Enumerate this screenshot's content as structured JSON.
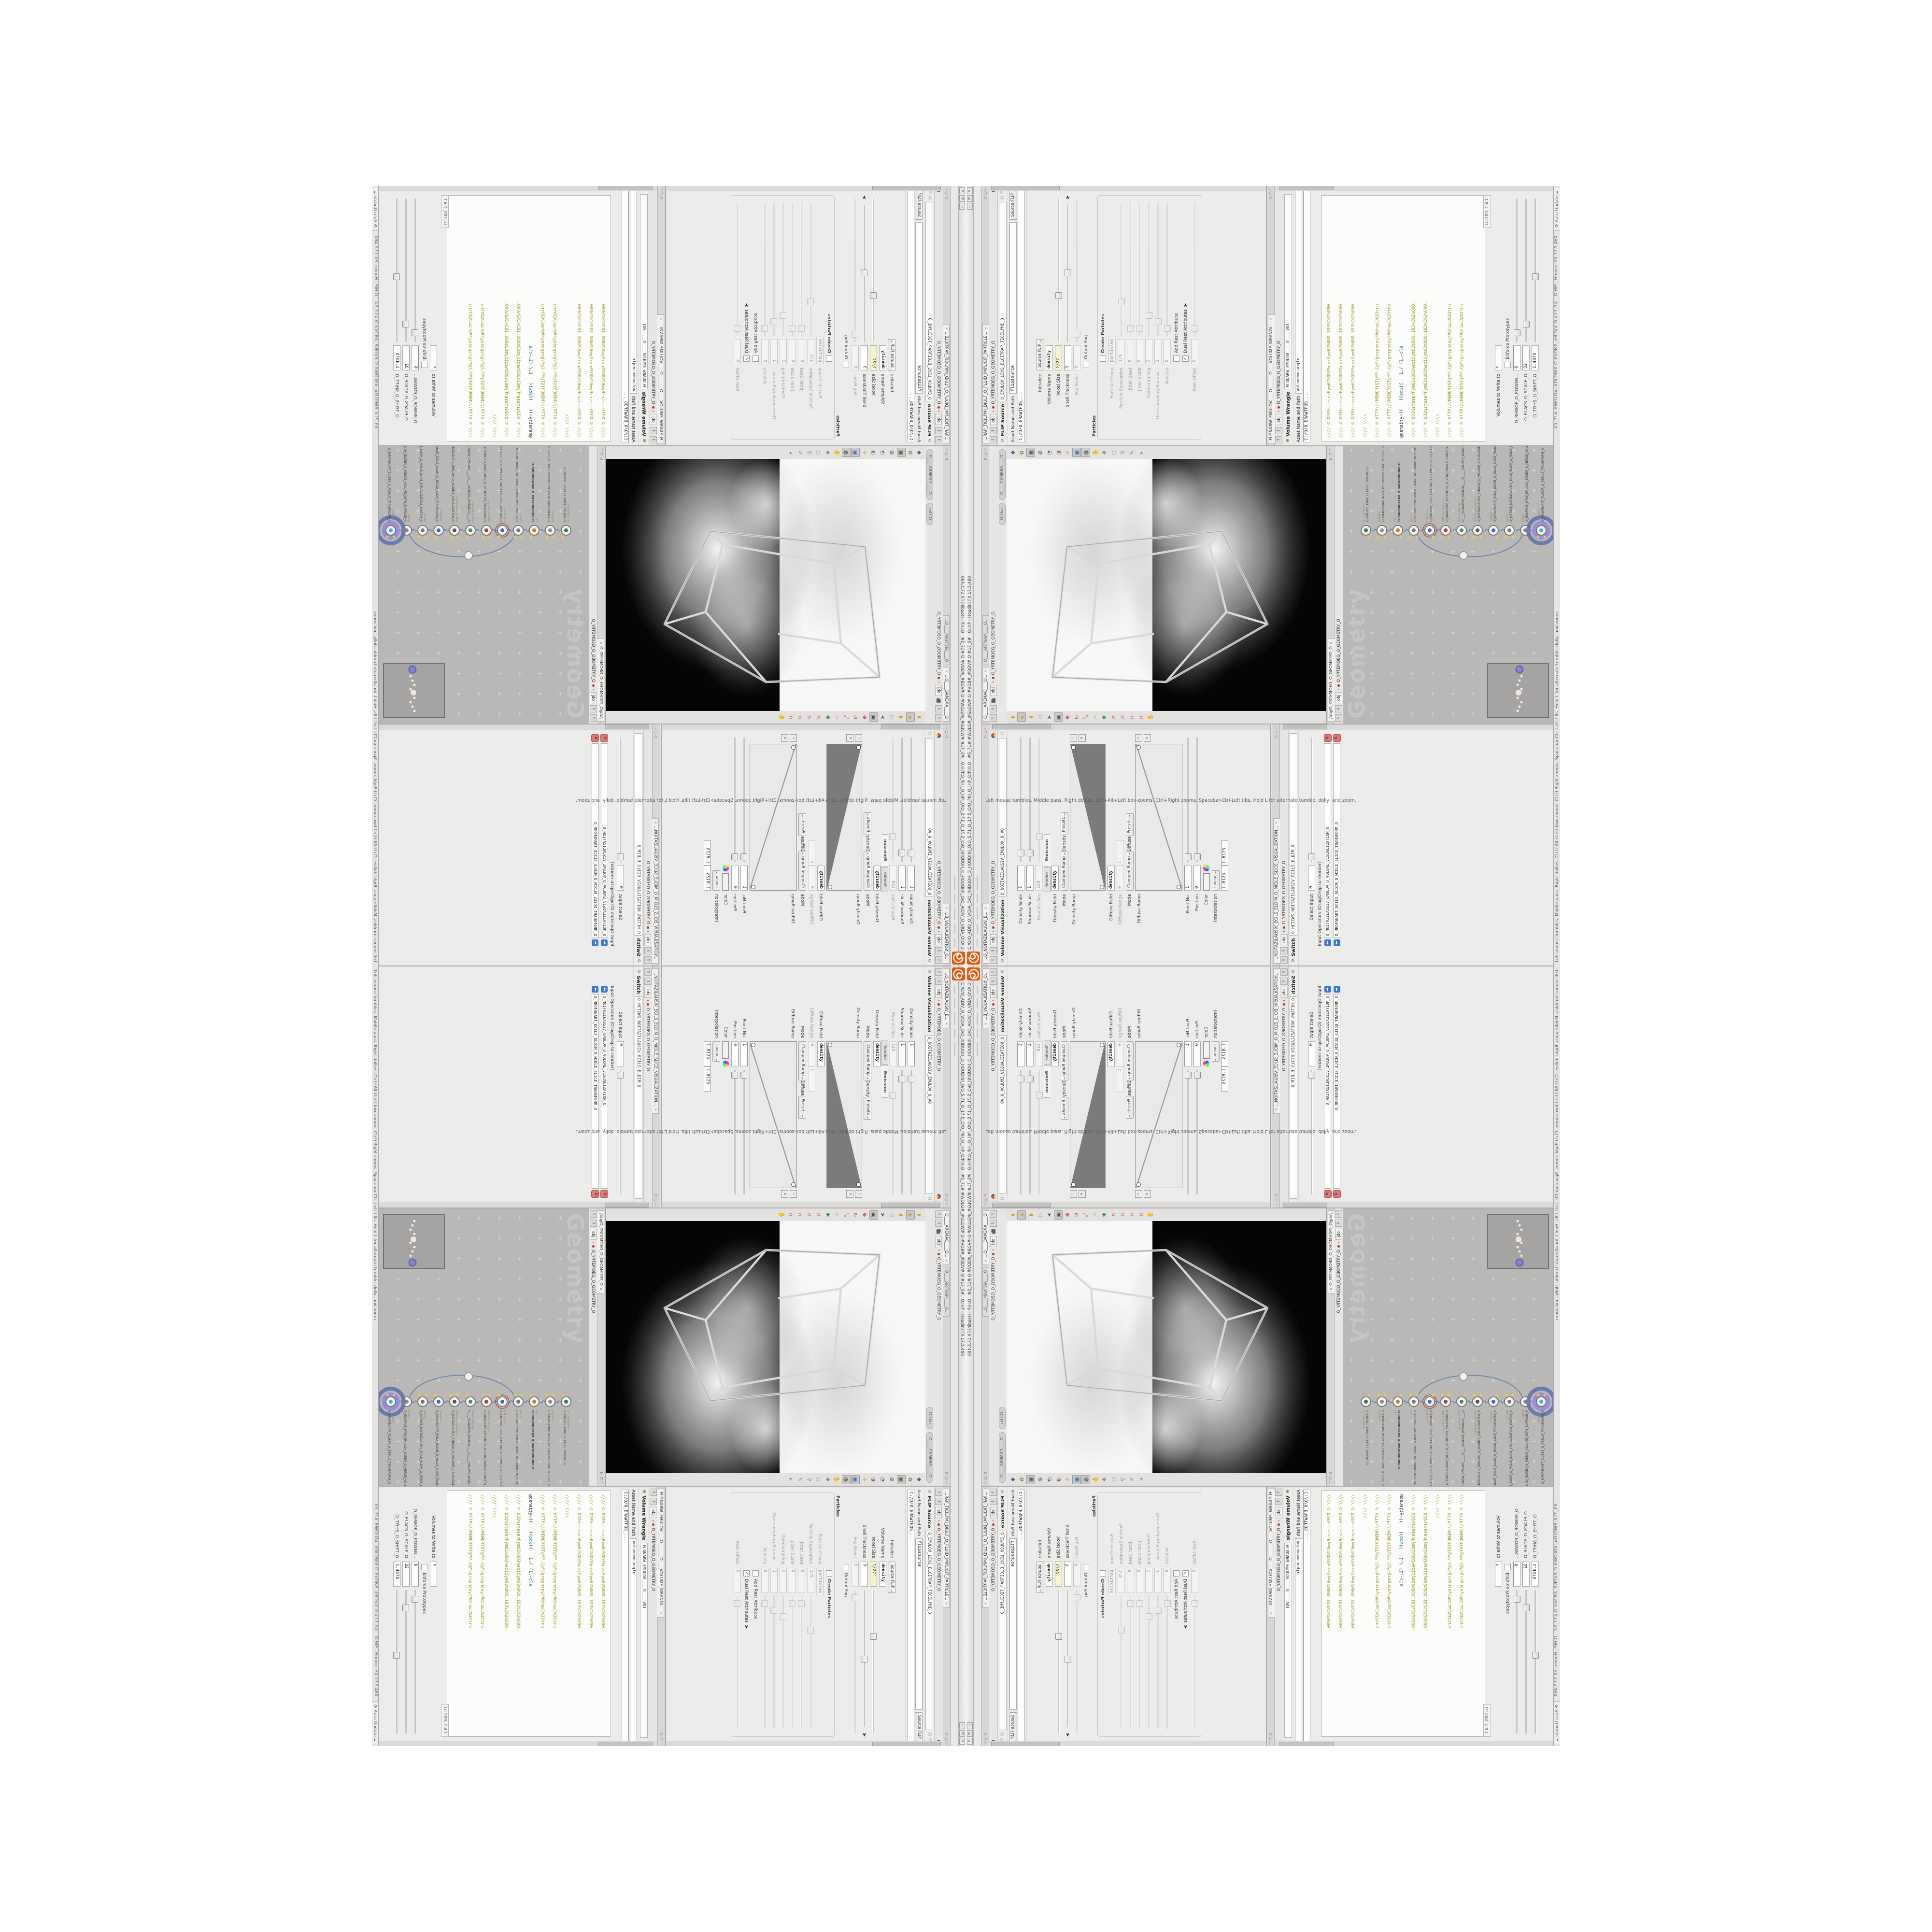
{
  "window": {
    "title": "C:/O/O_ADIV_O_VIDIA_O/O_INIDUOH_O_HOUDINI_O/O_5.71_O_17.5_O/O_PIH_O_HIP_O/PIH.O",
    "badges": "#5_71#   #WOLG#_#GLOW#   O   #VDB#_#BDV#   O   #17_5#",
    "app": "O.HIP - Houdini FX 17.5.460",
    "buttons": {
      "minimize": "▭",
      "maximize": "⧉",
      "close": "✕"
    }
  },
  "statusbar": {
    "help": "Left mouse tumbles. Middle pans. Right dollies. Ctrl+Alt+Left box-zooms. Ctrl+Right zooms. Spacebar-Ctrl-Left tilts. Hold L for alternate tumble, dolly, and zoom.",
    "auto_update": "Auto Update"
  },
  "path": {
    "root": "obj",
    "net": "O_YRTEMOEG_O_GEOMETRY_O",
    "full": "/obj/O_YRTEMOEG_O_GEOMETRY_O"
  },
  "flip": {
    "tab": "...RAP_TICILPMI_DIULF_O_FLUID_IMPLICIT_PARTICLE...",
    "type": "FLIP Source",
    "name": "O_EMULOV_LEHS_ELCITRAP_TICILPMI_D",
    "asset_label": "Asset Name and Path",
    "asset_name": "flipsource",
    "asset_menu": "Source FLIP",
    "asset_path": "C:/O/O_ERAWTFOS_...",
    "params": [
      {
        "l": "Initialize",
        "w": [
          {
            "k": "sel",
            "v": "Source FLIP"
          }
        ]
      },
      {
        "l": "Volume Name",
        "w": [
          {
            "k": "f",
            "v": "density",
            "c": "bold"
          }
        ]
      },
      {
        "l": "Voxel Size",
        "w": [
          {
            "k": "f",
            "v": "1/27",
            "c": "yellow"
          },
          {
            "k": "s",
            "f": 0.32
          }
        ]
      },
      {
        "l": "Shell Thickness",
        "w": [
          {
            "k": "f",
            "v": "3"
          },
          {
            "k": "s",
            "f": 0.5
          },
          {
            "k": "cur"
          }
        ]
      },
      {
        "l": "Fog Boost",
        "dim": 1,
        "w": [
          {
            "k": "f",
            "v": "0"
          },
          {
            "k": "s",
            "f": 0.05
          }
        ]
      },
      {
        "l": "",
        "w": [
          {
            "k": "chk",
            "on": 0
          },
          {
            "k": "lab",
            "v": "Output Fog"
          }
        ]
      },
      {
        "group": "Particles"
      },
      {
        "l": "",
        "g": 1,
        "w": [
          {
            "k": "chk",
            "on": 0
          },
          {
            "k": "lab",
            "v": "Create Particles",
            "c": "bold"
          }
        ]
      },
      {
        "l": "Particle Group",
        "g": 1,
        "dim": 1,
        "w": [
          {
            "k": "f",
            "v": "particles"
          }
        ]
      },
      {
        "l": "Particle Separation",
        "g": 1,
        "dim": 1,
        "w": [
          {
            "k": "f",
            "v": "1/9"
          },
          {
            "k": "s",
            "f": 0.25
          }
        ]
      },
      {
        "l": "Jitter Seed",
        "g": 1,
        "dim": 1,
        "w": [
          {
            "k": "f",
            "v": "0"
          },
          {
            "k": "s",
            "f": 0.05
          }
        ]
      },
      {
        "l": "Jitter Scale",
        "g": 1,
        "dim": 1,
        "w": [
          {
            "k": "f",
            "v": "0"
          },
          {
            "k": "s",
            "f": 0.05
          }
        ]
      },
      {
        "l": "Oversampling",
        "g": 1,
        "dim": 1,
        "w": [
          {
            "k": "f",
            "v": "2"
          },
          {
            "k": "s",
            "f": 0.15
          }
        ]
      },
      {
        "l": "Oversampling Bandwi...",
        "g": 1,
        "dim": 1,
        "w": [
          {
            "k": "f",
            "v": "1"
          },
          {
            "k": "s",
            "f": 0.1
          }
        ]
      },
      {
        "l": "Velocity",
        "g": 1,
        "dim": 1,
        "w": [
          {
            "k": "f",
            "v": "0"
          },
          {
            "k": "s",
            "f": 0.05
          }
        ]
      },
      {
        "l": "",
        "g": 1,
        "w": [
          {
            "k": "chk",
            "on": 0
          },
          {
            "k": "lab",
            "v": "Add Rest Attribute"
          }
        ]
      },
      {
        "l": "",
        "g": 1,
        "w": [
          {
            "k": "chk",
            "on": 1
          },
          {
            "k": "lab",
            "v": "Dual Rest Attributes"
          },
          {
            "k": "cur"
          }
        ]
      },
      {
        "l": "Rest Offset",
        "g": 1,
        "dim": 1,
        "w": [
          {
            "k": "f",
            "v": "0"
          },
          {
            "k": "s",
            "f": 0.05
          }
        ]
      }
    ]
  },
  "wrangle": {
    "tab": "ELGNARW_EMULOV____O_______O____VOLUME_WRANGL...",
    "type": "Volume Wrangle",
    "name": "ELGNARW_EMULOV____O____VOI",
    "asset_label": "Asset Name and Path",
    "asset_name": "volumewrangle",
    "asset_path": "C:/O/O_ERAWTFOS_...",
    "code": [
      {
        "c": "lc",
        "t": "//// © 0D3%steserPym62%0D3%eziSym62%000.1D3%C62%000."
      },
      {
        "c": "lc",
        "t": "//// © 0D3%steserPym62%0D3%eziSym62%000.1D3%C62%000."
      },
      {
        "c": "lc",
        "t": "//// © 0D3%steserPym62%0D3%eziSym62%000.1D3%C62%000."
      },
      {
        "c": "lc",
        "t": "//// \\\\\\\\"
      },
      {
        "c": "lc",
        "t": "//// © HTTP://MEMORYST@MP.C@M/graphtoy/#draw1%3Dtru"
      },
      {
        "c": "lc",
        "t": "//// © HTTP://MEMORYST@MP.C@M/graphtoy/#draw1%3Dtru"
      },
      {
        "seg": [
          [
            "@density=((   ",
            "lk"
          ],
          [
            "((",
            "lk"
          ],
          [
            "pow",
            "lfn"
          ],
          [
            "((   ",
            "lk"
          ],
          [
            "1./ (1.-",
            "lk"
          ],
          [
            "cla",
            "lfn"
          ]
        ]
      },
      {
        "c": "lc",
        "t": "//// © 0D3%steserPym62%0D3%eziSym62%000.1D3%C62%000."
      },
      {
        "c": "lc",
        "t": "//// © 0D3%steserPym62%0D3%eziSym62%000.1D3%C62%000."
      },
      {
        "c": "lc",
        "t": "//// \\\\\\\\"
      },
      {
        "c": "lc",
        "t": "//// © HTTP://MEMORYST@MP.C@M/graphtoy/#draw1%3Dtru"
      },
      {
        "c": "lc",
        "t": "//// © HTTP://MEMORYST@MP.C@M/graphtoy/#draw1%3Dtru"
      }
    ],
    "ln": "Ln 209, Col 1",
    "params": [
      {
        "l": "Volumes to Write to",
        "w": [
          {
            "k": "f",
            "v": "*"
          }
        ]
      },
      {
        "l": "",
        "w": [
          {
            "k": "chk",
            "on": 0
          },
          {
            "k": "lab",
            "v": "Enforce Prototypes"
          }
        ]
      },
      {
        "l": "O_REWOP_O_POWER...",
        "w": [
          {
            "k": "f",
            "v": "6"
          },
          {
            "k": "s",
            "f": 0.06
          }
        ]
      },
      {
        "l": "O_ELACS_O_SCALE_O",
        "w": [
          {
            "k": "f",
            "v": "32"
          },
          {
            "k": "s",
            "f": 0.12
          }
        ]
      },
      {
        "l": "O_TFIHS_O_SHIFT_O",
        "w": [
          {
            "k": "f",
            "v": "1.4375"
          },
          {
            "k": "s",
            "f": 0.45
          }
        ]
      }
    ]
  },
  "volvis": {
    "tab": "...O_NOITAZILAUSIV_E...",
    "type": "Volume Visualization",
    "name": "O_NOITAZILAUSIV_EMULOV_O_VO",
    "params": [
      {
        "l": "Density Scale",
        "w": [
          {
            "k": "f",
            "v": "1"
          },
          {
            "k": "s",
            "f": 0.07
          }
        ]
      },
      {
        "l": "Shadow Scale",
        "w": [
          {
            "k": "f",
            "v": "1"
          },
          {
            "k": "s",
            "f": 0.07
          }
        ]
      },
      {
        "l": "Max Vis Res",
        "dim": 1,
        "w": [
          {
            "k": "f",
            "v": "128"
          },
          {
            "k": "s",
            "f": 0.2
          }
        ]
      },
      {
        "tabs": [
          "Smoke",
          "Emission"
        ],
        "active": 1
      },
      {
        "l": "Density Field",
        "w": [
          {
            "k": "f",
            "v": "density",
            "c": "bold"
          }
        ]
      },
      {
        "l": "Mode",
        "w": [
          {
            "k": "sel",
            "v": "Clamped Ramp"
          },
          {
            "k": "lab",
            "v": "Density"
          },
          {
            "k": "sel",
            "v": "Presets"
          }
        ]
      },
      {
        "ramp": "wedge",
        "l": "Density Ramp",
        "h": 72
      },
      {
        "l": "Diffuse Field",
        "w": [
          {
            "k": "f",
            "v": "density",
            "c": "bold"
          }
        ]
      },
      {
        "l": "Diffuse Range",
        "dim": 1,
        "w": [
          {
            "k": "f",
            "v": "0"
          },
          {
            "k": "f",
            "v": "1"
          }
        ]
      },
      {
        "l": "Mode",
        "w": [
          {
            "k": "sel",
            "v": "Clamped Ramp"
          },
          {
            "k": "lab",
            "v": "Diffuse"
          },
          {
            "k": "sel",
            "v": "Presets"
          }
        ]
      },
      {
        "ramp": "line",
        "l": "Diffuse Ramp",
        "h": 96
      },
      {
        "l": "Point No.",
        "w": [
          {
            "k": "f",
            "v": "1"
          },
          {
            "k": "s",
            "f": 0.04
          }
        ]
      },
      {
        "l": "Position",
        "w": [
          {
            "k": "f",
            "v": "0"
          },
          {
            "k": "s",
            "f": 0.04
          }
        ]
      },
      {
        "l": "Color",
        "w": [
          {
            "k": "sw"
          },
          {
            "k": "wheel"
          }
        ]
      },
      {
        "l": "Interpolation",
        "w": [
          {
            "k": "sel",
            "v": "Linear"
          }
        ]
      },
      {
        "l": "",
        "w": [
          {
            "k": "f",
            "v": "1.8125"
          },
          {
            "k": "f",
            "v": "1.8125"
          }
        ]
      }
    ]
  },
  "switch": {
    "tab": "...NOITAZILAUSIV_ECILS_ELDIM_O_MIDLE_SLICE_VISUALIZATION...",
    "type": "Switch",
    "name": "O_HCTIWS_NOITAZILAUSIV_ECILS_ELDIM_O",
    "params": [
      {
        "l": "Select Input",
        "w": [
          {
            "k": "f",
            "v": "0"
          },
          {
            "k": "s",
            "f": 0.04
          }
        ]
      }
    ],
    "oplabel": "Input Operators (Drag/Drop to reorder)",
    "ops": [
      "O_NOITAZILAUSIV_EMULOV_O_VOLUME_VISUALIZATION_O",
      "O_MROFSNART_ECILS_ELDIM_O_MIDLE_SLICE_TRANSFORM_O"
    ]
  },
  "viewport": {
    "tab_scene": "O____AREMAC____O...",
    "tab_render": "O____ARTNAM____O...",
    "pill_ortho": "Ortho",
    "pill_camera": "O____CAMERA____O",
    "display_icons": [
      {
        "g": "◆",
        "c": "#556070"
      },
      {
        "g": "✿",
        "c": "#4a8f3a"
      },
      {
        "g": "▣",
        "c": "#5a5a5a",
        "on": 1
      },
      {
        "g": "⊘",
        "c": "#333333"
      },
      {
        "g": "◔",
        "c": "#555555"
      },
      {
        "g": "◑",
        "c": "#777777"
      },
      {
        "g": "✛",
        "c": "#c9a227"
      },
      {
        "g": "▣",
        "c": "#3a6fc4",
        "on": 1
      },
      {
        "g": "◍",
        "c": "#2f2f2f",
        "on": 1
      },
      {
        "g": "✋",
        "c": "#70757d"
      },
      {
        "g": "❖",
        "c": "#70757d"
      },
      {
        "g": "○",
        "c": "#8a8a8a"
      },
      {
        "g": "⚲",
        "c": "#8a8a8a"
      },
      {
        "g": "✎",
        "c": "#8a8a8a"
      },
      {
        "g": "▸",
        "c": "#8a8a8a"
      }
    ],
    "tool_icons": [
      {
        "g": "◗",
        "c": "#c9a227"
      },
      {
        "g": "◈",
        "c": "#c9a227",
        "on": 1
      },
      {
        "g": "◖",
        "c": "#c9a227"
      },
      {
        "g": "◁",
        "c": "#999999"
      },
      {
        "g": "➤",
        "c": "#4a4a4a"
      },
      {
        "g": "▣",
        "c": "#4a4a4a",
        "on": 1
      },
      {
        "g": "✥",
        "c": "#c23b3b"
      },
      {
        "g": "↻",
        "c": "#c23b3b"
      },
      {
        "g": "⤡",
        "c": "#c23b3b"
      },
      {
        "g": "✂",
        "c": "#cc9999"
      },
      {
        "g": "✱",
        "c": "#3a8f3a"
      },
      {
        "g": "∩",
        "c": "#c23b3b"
      },
      {
        "g": "∩",
        "c": "#c23b3b"
      },
      {
        "g": "∩",
        "c": "#c23b3b"
      },
      {
        "g": "∩",
        "c": "#c23b3b"
      },
      {
        "g": "✋",
        "c": "#70757d"
      }
    ]
  },
  "network": {
    "watermark": "Geometry",
    "nodes": [
      {
        "sub": "an_CubeSphere",
        "label": "O_EREHPS_EBUC_O_CUBE_SPHERE_O",
        "c": "#3a7d44"
      },
      {
        "sub": "PolyWire",
        "label": "O_EMARFERIW_NOGYLOP_EREHPS_EBUC_O_CUBE_SPHERE_POLYGON_WIREFRAME_O",
        "c": "#8a8a8a"
      },
      {
        "sub": "File",
        "label": "O_DNUORGKCAB_O_BACKGROUND_O",
        "bold": 1,
        "c": "#d07a2c"
      },
      {
        "sub": "Switch",
        "label": "O_HCTIWS_YRTEMOEG_LANRETXE_LANRETNI_O_INTERNAL_EXTERNAL_GEOMETRY_SWITCH_O",
        "c": "#777777"
      },
      {
        "sub": "FLIP Source",
        "label": "O_EMULOV_LEHS_ELCITRAP_TICILPMI_DIULF_O_FLUID_IMPLICIT_PARTICLE_SHEL_VOLUME_O",
        "ring": "#b05050",
        "c": "#4a6fa5"
      },
      {
        "sub": "VDB from Polygons",
        "label": "O_SNOGILOP_YRTEMOEG_O_VDB_FROM_GEOMETRY_BDV_O",
        "c": "#b04040"
      },
      {
        "sub": "Volume Wrangle",
        "label": "O____ELGNARW_EMULOV____O_____VOLUME_WRANGLE_O",
        "c": "#4f8f4f",
        "dot2": "#8fb7e8"
      },
      {
        "sub": "Volume Visualization",
        "label": "O_NOITAZILAUSIV_EMULOV_O_VOLUME_VISUALIZATION_O",
        "c": "#5a5a5a"
      },
      {
        "sub": "Transform",
        "label": "O_MROFSNART_ECILS_ELDIM_O_MIDLE_SLICE_TRANSFORM_O",
        "c": "#3a6fc4"
      },
      {
        "sub": "Switch",
        "label": "O_HCTIWS_NOITAZILAUSIV_ECILS_ELDIM_O_MIDLE_SLICE_VISUALIZATION_SWITCH_O",
        "c": "#777777"
      },
      {
        "sub": "Merge",
        "label": "O_ECAFRUS_HTIW_EMULOV_EGREM_O_MERGE_VOLUME_WITH_SURFACE_O",
        "c": "#8a8a8a"
      },
      {
        "sub": "Transform",
        "label": "O_MROFSNART_TLUSER_O_RESULT_TRANSFORM_O",
        "glow": 1,
        "c": "#44b1c9"
      }
    ]
  }
}
